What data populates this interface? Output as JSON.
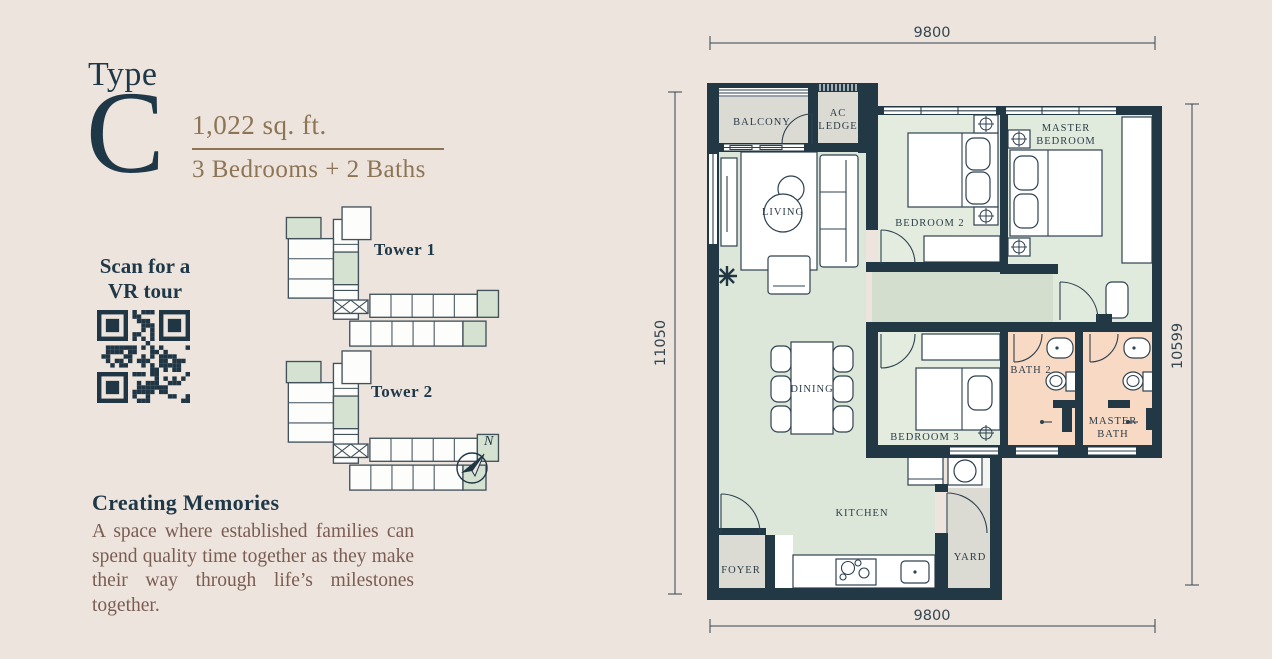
{
  "unit": {
    "type_label": "Type",
    "type_letter": "C",
    "area": "1,022 sq. ft.",
    "config": "3 Bedrooms + 2 Baths"
  },
  "vr": {
    "scan_text": "Scan for a VR tour"
  },
  "towers": {
    "tower1_label": "Tower 1",
    "tower2_label": "Tower 2"
  },
  "compass": {
    "north": "N"
  },
  "description": {
    "heading": "Creating Memories",
    "body": "A space where established families can spend quality time together as they make their way through life’s milestones together."
  },
  "plan": {
    "dimensions": {
      "top": "9800",
      "bottom": "9800",
      "left": "11050",
      "right": "10599"
    },
    "rooms": {
      "balcony": "BALCONY",
      "ac_ledge_line1": "AC",
      "ac_ledge_line2": "LEDGE",
      "living": "LIVING",
      "bedroom2": "BEDROOM 2",
      "master_bedroom_line1": "MASTER",
      "master_bedroom_line2": "BEDROOM",
      "dining": "DINING",
      "bedroom3": "BEDROOM 3",
      "bath2": "BATH 2",
      "master_bath_line1": "MASTER",
      "master_bath_line2": "BATH",
      "kitchen": "KITCHEN",
      "yard": "YARD",
      "foyer": "FOYER"
    },
    "colors": {
      "wall_navy": "#233845",
      "text_navy": "#1f3848",
      "accent_gold": "#8d7455",
      "body_brown": "#7a5c52",
      "room_green": "#dde7d9",
      "bedroom_green": "#e3ecdf",
      "hall_green": "#d3decf",
      "bath_peach": "#f8d9c3",
      "service_gray": "#dbdad3",
      "background": "#ece4dd"
    }
  }
}
